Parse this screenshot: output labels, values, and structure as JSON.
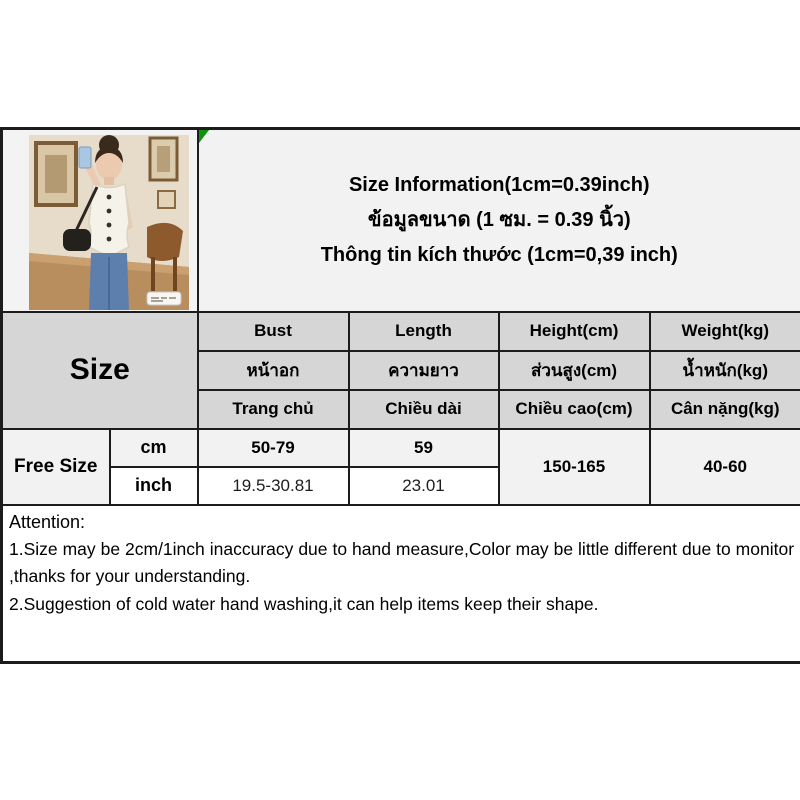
{
  "colors": {
    "table_border": "#1c1c1c",
    "header_bg": "#d6d6d6",
    "light_row_bg": "#f2f2f2",
    "white_row_bg": "#ffffff",
    "comment_marker_green": "#0d930d"
  },
  "title": {
    "line_en": "Size Information(1cm=0.39inch)",
    "line_th": "ข้อมูลขนาด (1 ซม. = 0.39 นิ้ว)",
    "line_vi": "Thông tin kích thước (1cm=0,39 inch)"
  },
  "size_table": {
    "size_header": "Size",
    "columns": [
      {
        "en": "Bust",
        "th": "หน้าอก",
        "vi": "Trang chủ"
      },
      {
        "en": "Length",
        "th": "ความยาว",
        "vi": "Chiều dài"
      },
      {
        "en": "Height(cm)",
        "th": "ส่วนสูง(cm)",
        "vi": "Chiều cao(cm)"
      },
      {
        "en": "Weight(kg)",
        "th": "น้ำหนัก(kg)",
        "vi": "Cân nặng(kg)"
      }
    ],
    "size_name": "Free Size",
    "rows": [
      {
        "unit": "cm",
        "bust": "50-79",
        "length": "59"
      },
      {
        "unit": "inch",
        "bust": "19.5-30.81",
        "length": "23.01"
      }
    ],
    "height_range": "150-165",
    "weight_range": "40-60"
  },
  "attention": {
    "heading": "Attention:",
    "note1": "1.Size may be 2cm/1inch inaccuracy due to hand measure,Color may be little different due to monitor ,thanks for your understanding.",
    "note2": "2.Suggestion of cold water hand washing,it can help items keep their shape."
  }
}
